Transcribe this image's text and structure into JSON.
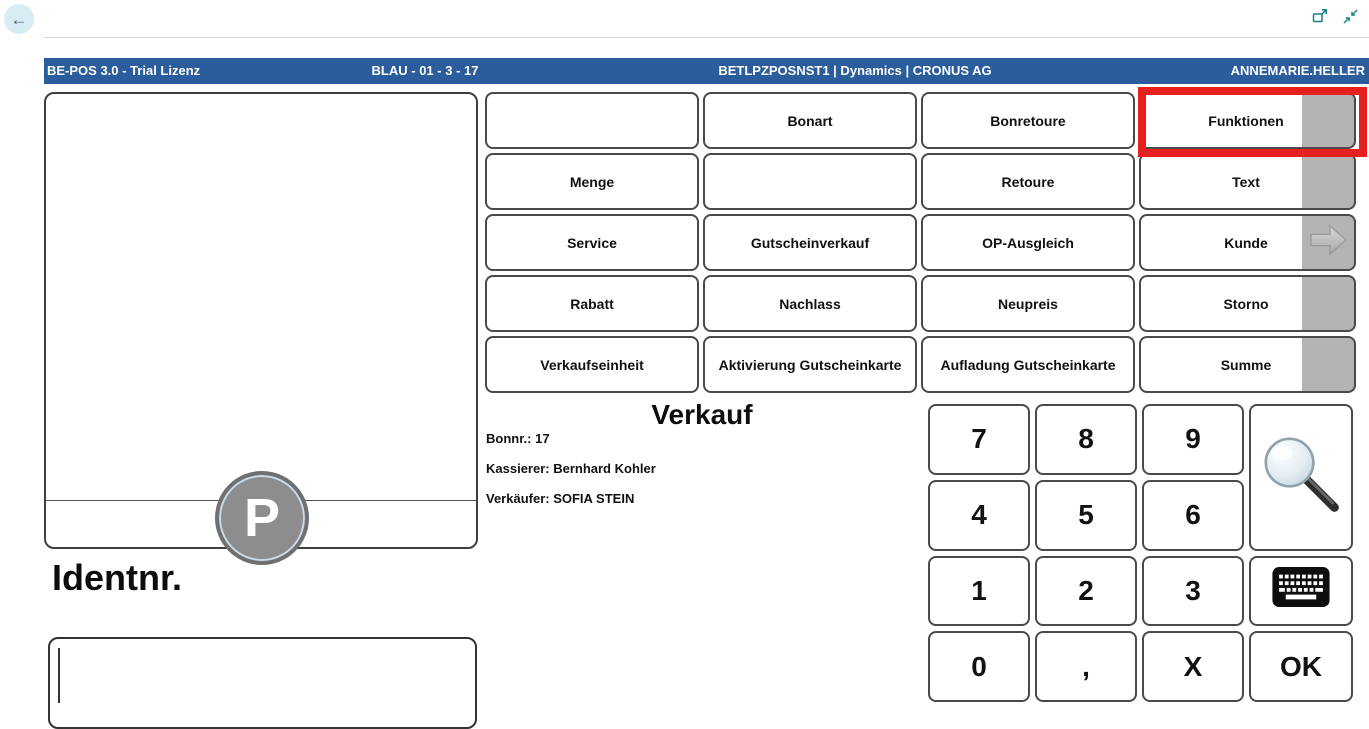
{
  "chrome": {
    "back_icon": "←",
    "popout_icon": "pop-out-window",
    "collapse_icon": "collapse-window"
  },
  "header": {
    "app_title": "BE-POS 3.0 - Trial Lizenz",
    "register": "BLAU - 01 - 3 - 17",
    "environment": "BETLPZPOSNST1 | Dynamics | CRONUS AG",
    "user": "ANNEMARIE.HELLER"
  },
  "colors": {
    "header_bg": "#2b5d9d",
    "accent_teal": "#17808a",
    "highlight_red": "#e5201e",
    "pager_gray": "#b4b4b4"
  },
  "function_buttons": {
    "rows": [
      [
        "",
        "Bonart",
        "Bonretoure",
        "Funktionen"
      ],
      [
        "Menge",
        "",
        "Retoure",
        "Text"
      ],
      [
        "Service",
        "Gutscheinverkauf",
        "OP-Ausgleich",
        "Kunde"
      ],
      [
        "Rabatt",
        "Nachlass",
        "Neupreis",
        "Storno"
      ],
      [
        "Verkaufseinheit",
        "Aktivierung Gutscheinkarte",
        "Aufladung Gutscheinkarte",
        "Summe"
      ]
    ],
    "highlighted_button": "Funktionen"
  },
  "sale_panel": {
    "title": "Verkauf",
    "receipt_line": "Bonnr.: 17",
    "cashier_line": "Kassierer: Bernhard Kohler",
    "seller_line": "Verkäufer: SOFIA STEIN"
  },
  "receipt_panel": {
    "logo_letter": "P"
  },
  "entry": {
    "label": "Identnr.",
    "value": ""
  },
  "numpad": {
    "digits": [
      "7",
      "8",
      "9",
      "4",
      "5",
      "6",
      "1",
      "2",
      "3"
    ],
    "bottom_row": [
      "0",
      ",",
      "X"
    ],
    "ok_label": "OK"
  }
}
